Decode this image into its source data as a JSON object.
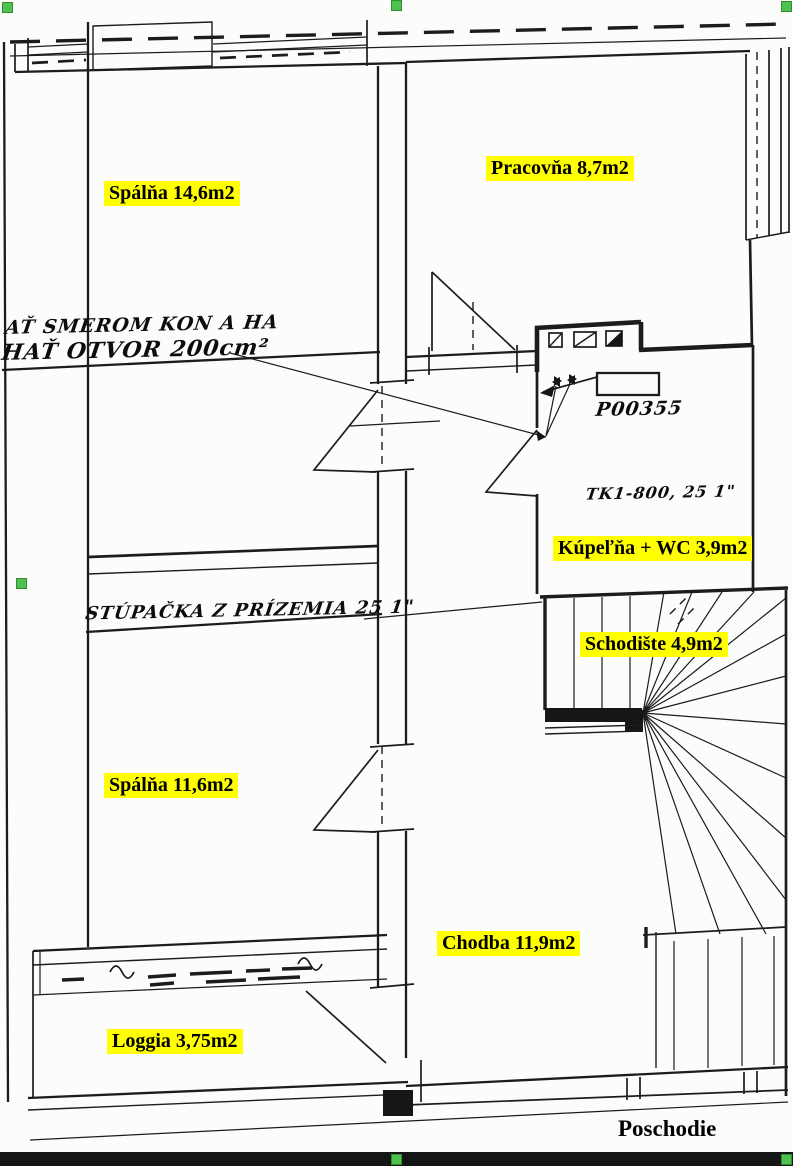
{
  "plan": {
    "title": "Poschodie",
    "rooms": [
      {
        "key": "spalna-146",
        "label": "Spálňa 14,6m2"
      },
      {
        "key": "pracovna",
        "label": "Pracovňa 8,7m2"
      },
      {
        "key": "kupelna-wc",
        "label": "Kúpeľňa + WC 3,9m2"
      },
      {
        "key": "schodiste",
        "label": "Schodište 4,9m2"
      },
      {
        "key": "spalna-116",
        "label": "Spálňa 11,6m2"
      },
      {
        "key": "chodba",
        "label": "Chodba 11,9m2"
      },
      {
        "key": "loggia",
        "label": "Loggia 3,75m2"
      }
    ],
    "annotations": {
      "vent_note": {
        "line1": "AŤ SMEROM KON A HA",
        "line2": "HAŤ OTVOR 200cm²"
      },
      "riser_note": "STÚPAČKA Z PRÍZEMIA 25 1\"",
      "code_note": "P00355",
      "tk_note": "TK1-800, 25 1\""
    },
    "colors": {
      "highlight": "#ffff00",
      "ink": "#1c1c1c",
      "selection_handle": "#4ec04e",
      "paper": "#fcfcfa",
      "scan_bar": "#151515"
    }
  }
}
